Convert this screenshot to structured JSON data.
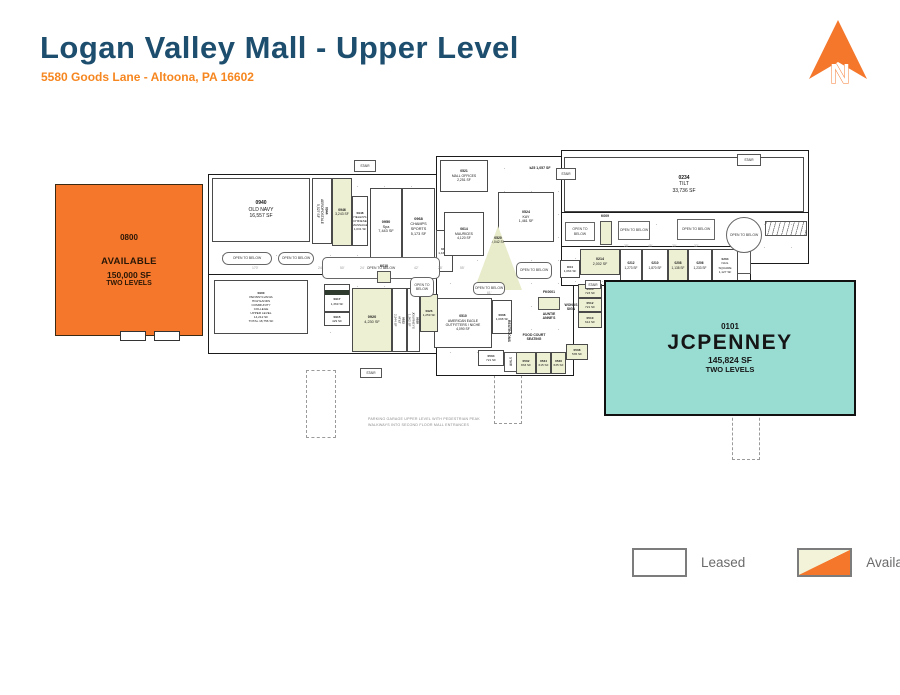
{
  "header": {
    "title": "Logan Valley Mall - Upper Level",
    "subtitle": "5580 Goods Lane - Altoona, PA 16602"
  },
  "north": {
    "label": "N"
  },
  "colors": {
    "title_blue": "#1d4e6e",
    "accent_orange": "#f4772c",
    "jcpenney_teal": "#99dcd2",
    "available_fill": "#eef0d4",
    "line": "#1b1b1b"
  },
  "anchors": {
    "available": {
      "id": "0800",
      "status": "AVAILABLE",
      "sf": "150,000 SF",
      "levels": "TWO LEVELS"
    },
    "jcpenney": {
      "id": "0101",
      "name": "JCPENNEY",
      "sf": "145,824 SF",
      "levels": "TWO LEVELS"
    }
  },
  "legend": {
    "items": [
      {
        "label": "Leased"
      },
      {
        "label": "Available"
      }
    ]
  },
  "plan": {
    "open_label": "OPEN TO BELOW",
    "stair_label": "STAIR",
    "stores": [
      {
        "id": "0940",
        "name": "OLD NAVY",
        "sf": "16,557 SF",
        "x": 212,
        "y": 178,
        "w": 98,
        "h": 64,
        "fs": 5
      },
      {
        "id": "0944",
        "name": "AEROPOSTALE|5,527 SF",
        "x": 312,
        "y": 178,
        "w": 20,
        "h": 66,
        "vert": true,
        "fs": 3.4
      },
      {
        "id": "0946",
        "sf": "3,243 SF",
        "x": 332,
        "y": 178,
        "w": 20,
        "h": 68,
        "avail": true,
        "fs": 3.4
      },
      {
        "id": "0948",
        "name": "HELEN'S|CHINESE|MASSAGE",
        "sf": "1,031 SF",
        "x": 352,
        "y": 196,
        "w": 16,
        "h": 50,
        "fs": 3.1
      },
      {
        "id": "0950",
        "name": "Spa",
        "sf": "7,443 SF",
        "x": 370,
        "y": 188,
        "w": 32,
        "h": 78,
        "fs": 3.8
      },
      {
        "id": "0968",
        "name": "CHAMPS|SPORTS",
        "sf": "5,173 SF",
        "x": 402,
        "y": 188,
        "w": 33,
        "h": 78,
        "fs": 3.8
      },
      {
        "id": "0412",
        "sf": "1,435 SF",
        "x": 436,
        "y": 230,
        "w": 17,
        "h": 42,
        "fs": 3.1
      },
      {
        "id": "0521",
        "name": "MALL OFFICES",
        "sf": "2,251 SF",
        "x": 440,
        "y": 160,
        "w": 48,
        "h": 32,
        "fs": 3.4
      },
      {
        "id": "0524",
        "name": "KAY",
        "sf": "1,461 SF",
        "x": 498,
        "y": 192,
        "w": 56,
        "h": 50,
        "fs": 3.6
      },
      {
        "id": "0614",
        "name": "MAURICES",
        "sf": "4,120 SF",
        "x": 444,
        "y": 212,
        "w": 40,
        "h": 44,
        "fs": 3.4
      },
      {
        "id": "0520",
        "sf": "2,042 SF",
        "x": 474,
        "y": 226,
        "w": 48,
        "h": 64,
        "avail": true,
        "tri": true,
        "fs": 3.4
      },
      {
        "id": "0234",
        "name": "TILT",
        "sf": "33,736 SF",
        "x": 564,
        "y": 157,
        "w": 240,
        "h": 55,
        "fs": 5
      },
      {
        "id": "K04",
        "sf": "1,064 SF",
        "x": 560,
        "y": 260,
        "w": 20,
        "h": 18,
        "fs": 3.1
      },
      {
        "id": "0214",
        "sf": "2,002 SF",
        "x": 580,
        "y": 249,
        "w": 40,
        "h": 26,
        "avail": true,
        "fs": 3.6
      },
      {
        "id": "0212",
        "sf": "1,273 SF",
        "x": 620,
        "y": 249,
        "w": 22,
        "h": 33,
        "fs": 3.2
      },
      {
        "id": "0210",
        "sf": "1,870 SF",
        "x": 642,
        "y": 249,
        "w": 26,
        "h": 33,
        "fs": 3.2
      },
      {
        "id": "0208",
        "sf": "1,138 SF",
        "x": 668,
        "y": 249,
        "w": 20,
        "h": 33,
        "avail": true,
        "fs": 3.2
      },
      {
        "id": "0206",
        "sf": "1,233 SF",
        "x": 688,
        "y": 249,
        "w": 24,
        "h": 33,
        "fs": 3.2
      },
      {
        "id": "0204",
        "name": "NAIL|SQUARE",
        "sf": "1,127 SF",
        "x": 712,
        "y": 249,
        "w": 26,
        "h": 33,
        "fs": 3.1
      },
      {
        "id": "0514",
        "sf": "723 SF",
        "x": 578,
        "y": 284,
        "w": 24,
        "h": 14,
        "avail": true,
        "fs": 3.1
      },
      {
        "id": "0512",
        "sf": "721 SF",
        "x": 578,
        "y": 298,
        "w": 24,
        "h": 14,
        "avail": true,
        "fs": 3.1
      },
      {
        "id": "0510",
        "sf": "612 SF",
        "x": 578,
        "y": 312,
        "w": 24,
        "h": 16,
        "avail": true,
        "fs": 3.1
      },
      {
        "id": "0510",
        "name": "AMERICAN EAGLE|OUTFITTERS / NICHE",
        "sf": "4,090 SF",
        "x": 434,
        "y": 298,
        "w": 58,
        "h": 50,
        "fs": 3.4
      },
      {
        "id": "0608",
        "sf": "1,098 SF",
        "x": 492,
        "y": 300,
        "w": 20,
        "h": 34,
        "fs": 3.1
      },
      {
        "id": "0504",
        "sf": "721 SF",
        "x": 478,
        "y": 350,
        "w": 26,
        "h": 16,
        "fs": 3.1
      },
      {
        "id": "0502",
        "sf": "833 SF",
        "x": 516,
        "y": 352,
        "w": 20,
        "h": 22,
        "avail": true,
        "fs": 3.1
      },
      {
        "id": "0534",
        "sf": "615 SF",
        "x": 536,
        "y": 352,
        "w": 15,
        "h": 22,
        "avail": true,
        "fs": 3.1
      },
      {
        "id": "0536",
        "sf": "635 SF",
        "x": 551,
        "y": 352,
        "w": 15,
        "h": 22,
        "avail": true,
        "fs": 3.1
      },
      {
        "id": "0508",
        "sf": "535 SF",
        "x": 566,
        "y": 344,
        "w": 22,
        "h": 16,
        "avail": true,
        "fs": 3.1
      },
      {
        "id": "0900",
        "name": "PENNSYLVANIA|HIGHLANDS|COMMUNITY|COLLEGE|UPPER LEVEL",
        "sf": "14,212 SF",
        "extra": "TOTAL 18,756 SF",
        "x": 214,
        "y": 280,
        "w": 94,
        "h": 54,
        "fs": 3.1
      },
      {
        "id": "0917",
        "sf": "1,369 SF",
        "x": 324,
        "y": 284,
        "w": 26,
        "h": 28,
        "hdr": true,
        "fs": 3.1
      },
      {
        "id": "0915",
        "sf": "429 SF",
        "x": 324,
        "y": 312,
        "w": 26,
        "h": 14,
        "fs": 3.1
      },
      {
        "id": "0920",
        "sf": "4,230 SF",
        "x": 352,
        "y": 288,
        "w": 40,
        "h": 64,
        "avail": true,
        "fs": 3.8
      },
      {
        "id": "0922",
        "name": "AT&T",
        "sf": "2,544 SF",
        "x": 392,
        "y": 288,
        "w": 15,
        "h": 64,
        "vert": true,
        "fs": 3.1
      },
      {
        "id": "0928",
        "name": "JOURNEYS",
        "sf": "1,362 SF",
        "x": 407,
        "y": 288,
        "w": 13,
        "h": 64,
        "vert": true,
        "fs": 3.1
      },
      {
        "id": "0926",
        "sf": "1,259 SF",
        "x": 420,
        "y": 294,
        "w": 18,
        "h": 38,
        "avail": true,
        "fs": 3.1
      }
    ],
    "open_to_below": [
      {
        "x": 222,
        "y": 252,
        "w": 50,
        "h": 13,
        "shape": "oval"
      },
      {
        "x": 278,
        "y": 252,
        "w": 36,
        "h": 13,
        "shape": "oval"
      },
      {
        "x": 322,
        "y": 257,
        "w": 118,
        "h": 22,
        "shape": "round"
      },
      {
        "x": 410,
        "y": 277,
        "w": 24,
        "h": 20,
        "shape": "round"
      },
      {
        "x": 473,
        "y": 282,
        "w": 32,
        "h": 13,
        "shape": "round"
      },
      {
        "x": 516,
        "y": 262,
        "w": 36,
        "h": 17,
        "shape": "round"
      },
      {
        "x": 565,
        "y": 222,
        "w": 30,
        "h": 19
      },
      {
        "x": 618,
        "y": 221,
        "w": 32,
        "h": 19
      },
      {
        "x": 677,
        "y": 219,
        "w": 38,
        "h": 21
      },
      {
        "x": 726,
        "y": 217,
        "w": 36,
        "h": 36,
        "shape": "circle"
      }
    ],
    "stairs": [
      {
        "x": 354,
        "y": 160,
        "w": 22,
        "h": 12
      },
      {
        "x": 556,
        "y": 168,
        "w": 20,
        "h": 12
      },
      {
        "x": 737,
        "y": 154,
        "w": 24,
        "h": 12
      },
      {
        "x": 585,
        "y": 280,
        "w": 16,
        "h": 9
      },
      {
        "x": 504,
        "y": 352,
        "w": 13,
        "h": 20,
        "vert": true
      },
      {
        "x": 360,
        "y": 368,
        "w": 22,
        "h": 10
      }
    ],
    "kiosks": [
      {
        "id": "K010",
        "x": 377,
        "y": 271,
        "w": 14,
        "h": 12
      },
      {
        "id": "K009",
        "x": 600,
        "y": 221,
        "w": 12,
        "h": 24
      },
      {
        "id": "FK0001",
        "x": 538,
        "y": 297,
        "w": 22,
        "h": 13
      }
    ],
    "labels": [
      {
        "t": "k25 1,057 SF",
        "x": 519,
        "y": 166,
        "w": 42,
        "fs": 3.5
      },
      {
        "t": "K010",
        "x": 377,
        "y": 264,
        "w": 14
      },
      {
        "t": "K009",
        "x": 594,
        "y": 214,
        "w": 22
      },
      {
        "t": "FK0001",
        "x": 532,
        "y": 290,
        "w": 34
      },
      {
        "t": "AUNTIE|ANNE'S",
        "x": 532,
        "y": 312,
        "w": 34
      },
      {
        "t": "WONDS|SIGN",
        "x": 560,
        "y": 303,
        "w": 22
      },
      {
        "t": "FOOD COURT|SEATING",
        "x": 512,
        "y": 333,
        "w": 44
      },
      {
        "t": "RESTROOMS",
        "x": 503,
        "y": 320,
        "w": 8,
        "vert": true
      },
      {
        "t": "PARKING GARAGE UPPER LEVEL WITH PEDESTRIAN PEAK",
        "x": 368,
        "y": 417,
        "w": 130,
        "cls": "note",
        "fs": 3.6
      },
      {
        "t": "WALKWAYS INTO SECOND FLOOR MALL ENTRANCES",
        "x": 368,
        "y": 423,
        "w": 130,
        "cls": "note",
        "fs": 3.6
      }
    ],
    "dims": [
      {
        "t": "170'",
        "x": 252,
        "y": 266
      },
      {
        "t": "24'",
        "x": 318,
        "y": 266
      },
      {
        "t": "50'",
        "x": 340,
        "y": 266
      },
      {
        "t": "24'",
        "x": 360,
        "y": 266
      },
      {
        "t": "40'",
        "x": 384,
        "y": 266
      },
      {
        "t": "42'",
        "x": 414,
        "y": 266
      },
      {
        "t": "28'",
        "x": 438,
        "y": 266
      },
      {
        "t": "55'",
        "x": 460,
        "y": 266
      },
      {
        "t": "61'",
        "x": 487,
        "y": 291
      },
      {
        "t": "28'",
        "x": 624,
        "y": 244
      },
      {
        "t": "45'",
        "x": 648,
        "y": 244
      },
      {
        "t": "20'",
        "x": 672,
        "y": 244
      },
      {
        "t": "32'",
        "x": 694,
        "y": 244
      }
    ],
    "entrances": [
      {
        "x": 306,
        "y": 370,
        "w": 28,
        "h": 66
      },
      {
        "x": 494,
        "y": 370,
        "w": 26,
        "h": 52
      },
      {
        "x": 732,
        "y": 408,
        "w": 26,
        "h": 50
      }
    ]
  }
}
